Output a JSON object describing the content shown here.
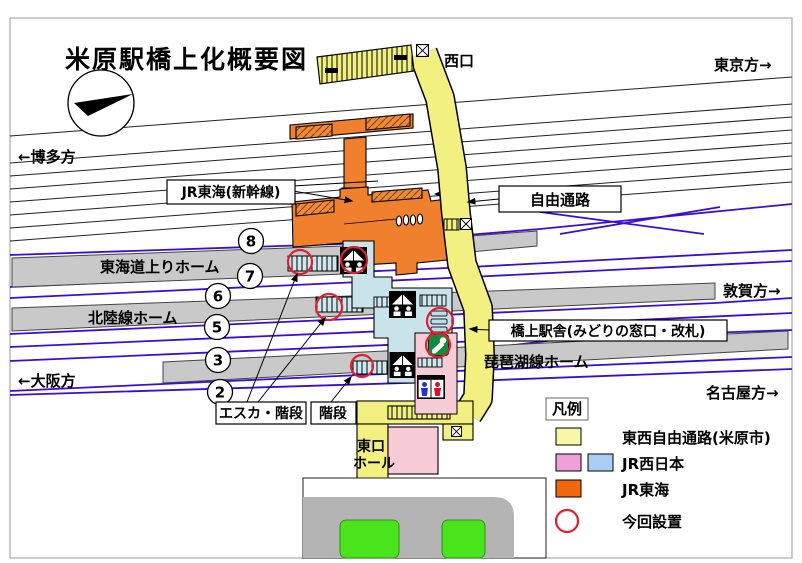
{
  "page": {
    "title": "米原駅橋上化概要図"
  },
  "directions": {
    "tokyo": "東京方→",
    "hakata": "←博多方",
    "tsuruga": "敦賀方→",
    "osaka": "←大阪方",
    "nagoya": "名古屋方→"
  },
  "callouts": {
    "west_exit": "西口",
    "jr_tokai_shinkansen": "JR東海(新幹線)",
    "free_passage": "自由通路",
    "bridge_station": "橋上駅舎(みどりの窓口・改札)",
    "esc_stairs": "エスカ・階段",
    "stairs": "階段",
    "east_hall_line1": "東口",
    "east_hall_line2": "ホール"
  },
  "platforms": {
    "tokaido_up": "東海道上りホーム",
    "hokuriku": "北陸線ホーム",
    "biwako": "琵琶湖線ホーム",
    "numbers": [
      "8",
      "7",
      "6",
      "5",
      "3",
      "2"
    ]
  },
  "legend": {
    "heading": "凡例",
    "items": [
      {
        "label": "東西自由通路(米原市)",
        "swatches": [
          "#f8f7a8"
        ]
      },
      {
        "label": "JR西日本",
        "swatches": [
          "#f0a0d8",
          "#a9cdf4"
        ]
      },
      {
        "label": "JR東海",
        "swatches": [
          "#f1670f"
        ]
      },
      {
        "label": "今回設置",
        "marker_color": "#e02030"
      }
    ]
  },
  "colors": {
    "passage_yellow": "#f2f080",
    "map_pink": "#f8ccd6",
    "map_blue": "#c8e4ea",
    "jr_tokai_orange": "#f07f2e",
    "platform_gray": "#c9c9c9",
    "road_gray": "#b4b4b4",
    "lawn_green": "#49e41c",
    "rail_purple": "#3c0dd0",
    "new_red": "#e02030"
  },
  "icons": {
    "escalator": "escalator-icon",
    "restroom": "restroom-icon",
    "ticket_office": "midori-no-madoguchi-icon",
    "ticket_gates": "ticket-gates-icon",
    "elevator": "elevator-icon",
    "stairs_strip": "stairs-hatch",
    "north_arrow": "north-arrow-icon",
    "new_install_marker": "red-circle-marker"
  }
}
